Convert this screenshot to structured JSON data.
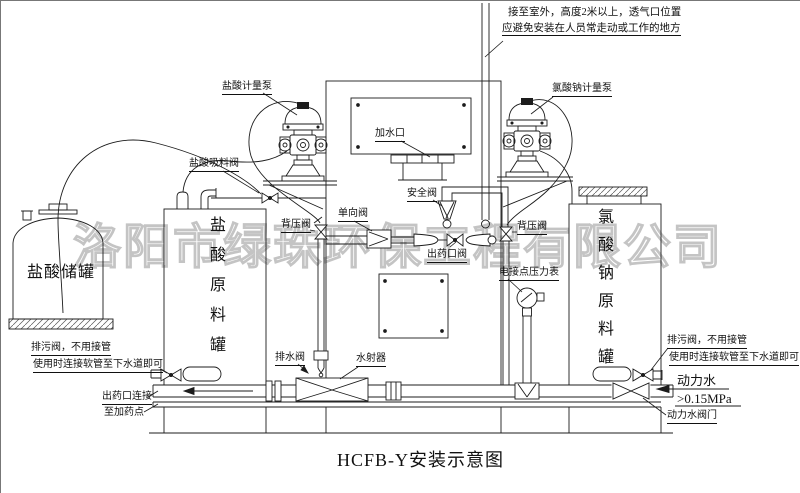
{
  "title": "HCFB-Y安装示意图",
  "watermark": "洛阳市绿珠环保工程有限公司",
  "notes": {
    "vent1": "接至室外，高度2米以上，透气口位置",
    "vent2": "应避免安装在人员常走动或工作的地方"
  },
  "tanks": {
    "storage": "盐酸储罐",
    "acid": "盐酸原料罐",
    "chlorate": "氯酸钠原料罐"
  },
  "labels": {
    "pump_left": "盐酸计量泵",
    "pump_right": "氯酸钠计量泵",
    "suction_valve": "盐酸吸料阀",
    "fill_port": "加水口",
    "safety_valve": "安全阀",
    "check_valve": "单向阀",
    "back_pressure": "背压阀",
    "outlet_valve": "出药口阀",
    "gauge": "电接点压力表",
    "drain_valve": "排水阀",
    "ejector": "水射器",
    "blowdown1": "排污阀，不用接管",
    "blowdown2": "使用时连接软管至下水道即可",
    "outlet_conn1": "出药口连接",
    "outlet_conn2": "至加药点",
    "power_water": "动力水",
    "pressure": ">0.15MPa",
    "power_valve": "动力水阀门"
  },
  "colors": {
    "ink": "#1c1c1c",
    "watermark": "#c4c4c4",
    "background": "#ffffff"
  }
}
